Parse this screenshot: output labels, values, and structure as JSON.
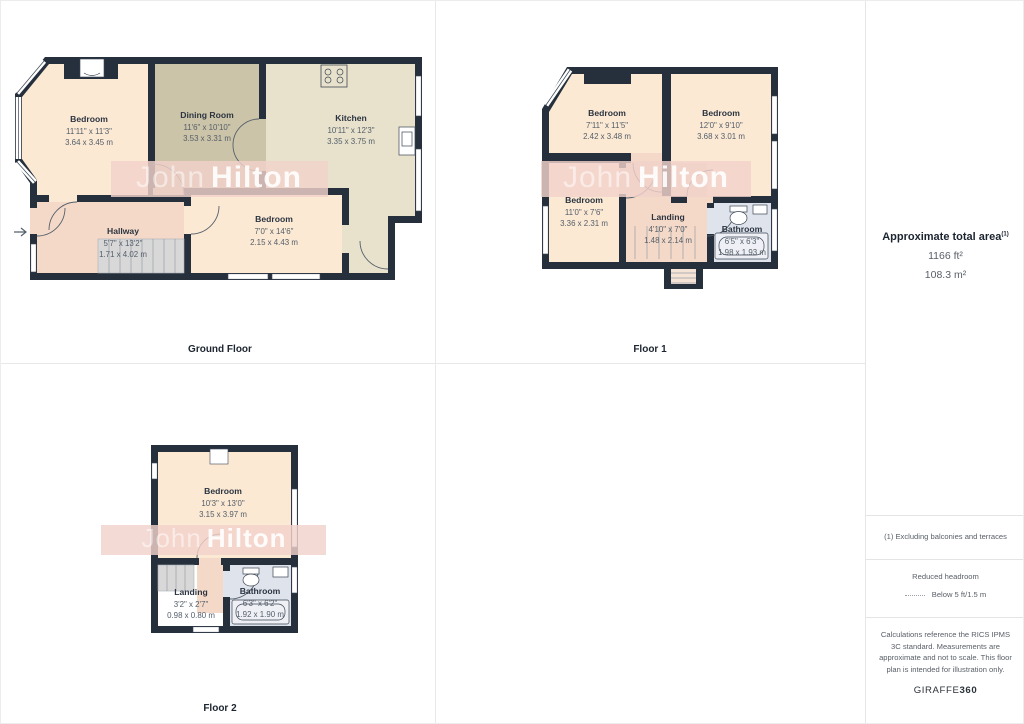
{
  "watermark": {
    "first": "John",
    "second": "Hilton"
  },
  "floors": [
    {
      "label": "Ground Floor",
      "rooms": {
        "bedroom1": {
          "name": "Bedroom",
          "ft": "11'11\" x 11'3\"",
          "m": "3.64 x 3.45 m"
        },
        "dining": {
          "name": "Dining Room",
          "ft": "11'6\" x 10'10\"",
          "m": "3.53 x 3.31 m"
        },
        "kitchen": {
          "name": "Kitchen",
          "ft": "10'11\" x 12'3\"",
          "m": "3.35 x 3.75 m"
        },
        "hallway": {
          "name": "Hallway",
          "ft": "5'7\" x 13'2\"",
          "m": "1.71 x 4.02 m"
        },
        "bedroom2": {
          "name": "Bedroom",
          "ft": "7'0\" x 14'6\"",
          "m": "2.15 x 4.43 m"
        }
      }
    },
    {
      "label": "Floor 1",
      "rooms": {
        "bedroom1": {
          "name": "Bedroom",
          "ft": "7'11\" x 11'5\"",
          "m": "2.42 x 3.48 m"
        },
        "bedroom2": {
          "name": "Bedroom",
          "ft": "12'0\" x 9'10\"",
          "m": "3.68 x 3.01 m"
        },
        "bedroom3": {
          "name": "Bedroom",
          "ft": "11'0\" x 7'6\"",
          "m": "3.36 x 2.31 m"
        },
        "landing": {
          "name": "Landing",
          "ft": "4'10\" x 7'0\"",
          "m": "1.48 x 2.14 m"
        },
        "bathroom": {
          "name": "Bathroom",
          "ft": "6'5\" x 6'3\"",
          "m": "1.98 x 1.93 m"
        }
      }
    },
    {
      "label": "Floor 2",
      "rooms": {
        "bedroom": {
          "name": "Bedroom",
          "ft": "10'3\" x 13'0\"",
          "m": "3.15 x 3.97 m"
        },
        "landing": {
          "name": "Landing",
          "ft": "3'2\" x 2'7\"",
          "m": "0.98 x 0.80 m"
        },
        "bathroom": {
          "name": "Bathroom",
          "ft": "6'3\" x 6'2\"",
          "m": "1.92 x 1.90 m"
        }
      }
    }
  ],
  "sidebar": {
    "area_title": "Approximate total area",
    "area_title_sup": "(1)",
    "area_ft": "1166 ft²",
    "area_m": "108.3 m²",
    "note1": "(1) Excluding balconies and terraces",
    "headroom_title": "Reduced headroom",
    "headroom_value": "Below 5 ft/1.5 m",
    "disclaimer": "Calculations reference the RICS IPMS 3C standard. Measurements are approximate and not to scale. This floor plan is intended for illustration only.",
    "brand_name": "GIRAFFE",
    "brand_suffix": "360"
  },
  "colors": {
    "wall": "#26303d",
    "room_cream": "#fbe9d4",
    "dining_khaki": "#ccc4a8",
    "kitchen_beige": "#e8e2cc",
    "hall_pink": "#f5d9c8",
    "bathroom_blue": "#dfe3ec",
    "stairs_grey": "#d8d8d8",
    "watermark_pink": "#f2d2cb"
  }
}
